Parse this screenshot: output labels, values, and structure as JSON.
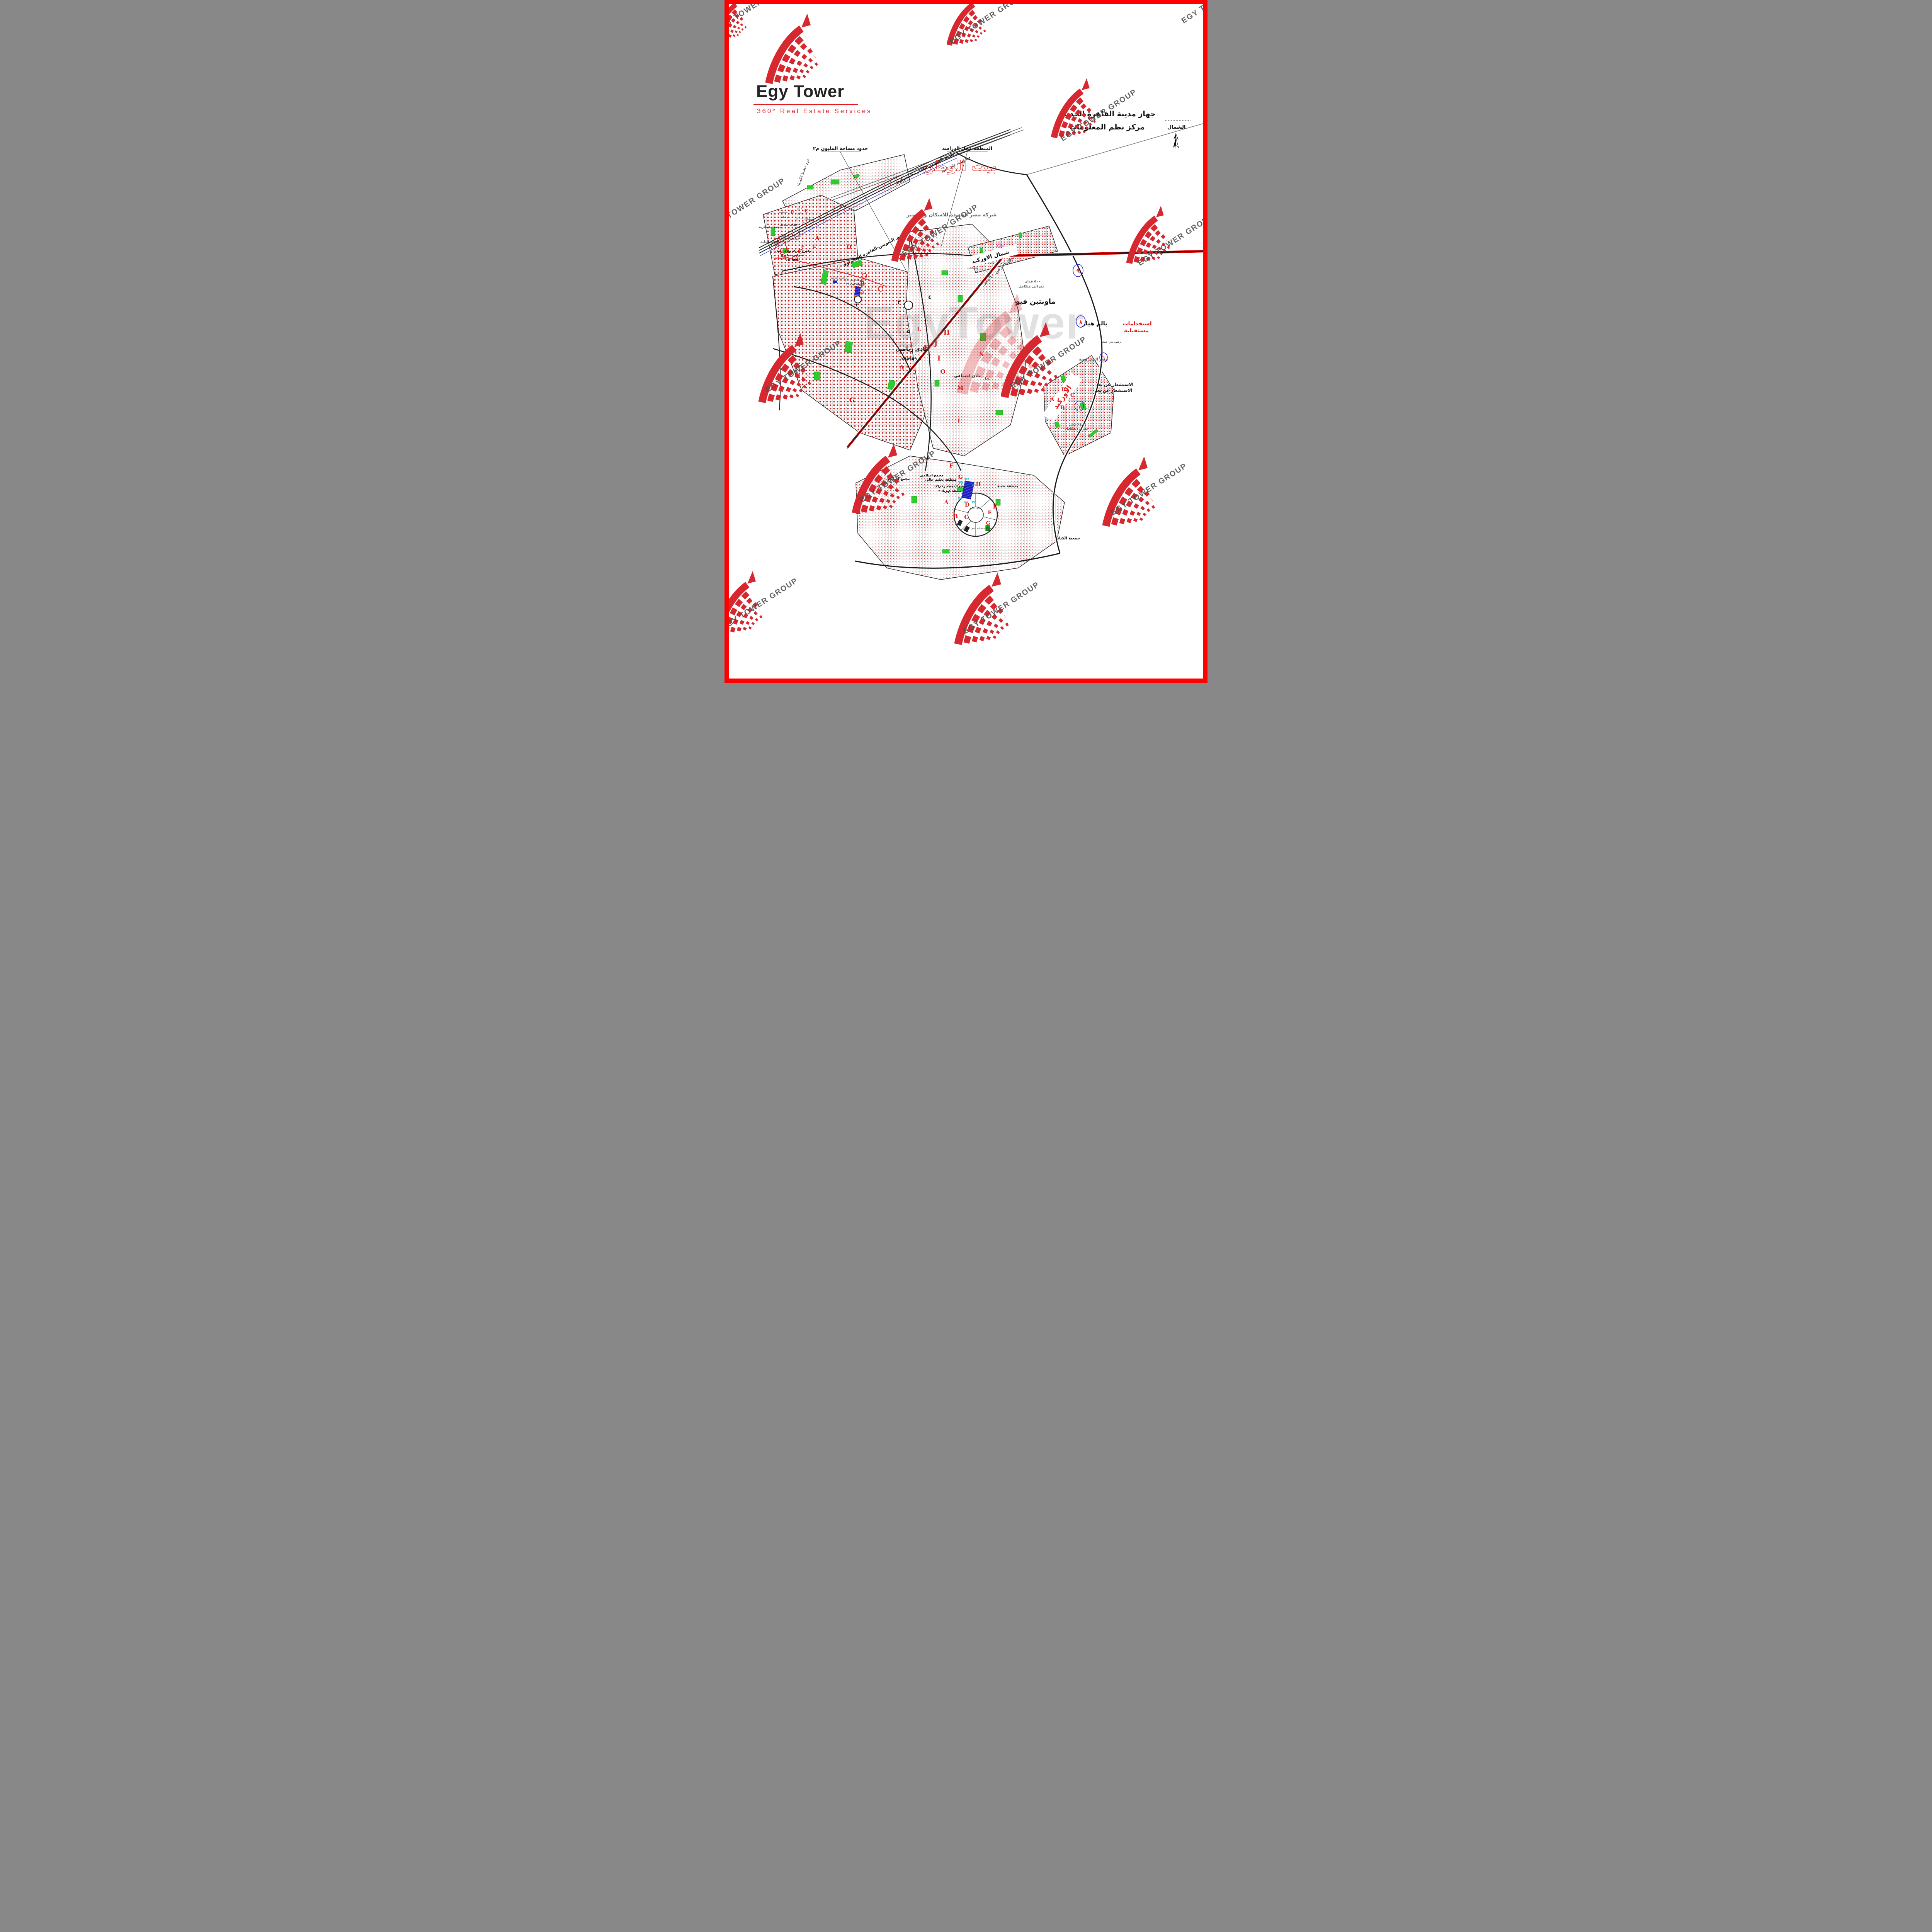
{
  "page": {
    "border_color": "#fe0000",
    "background": "#ffffff"
  },
  "logo": {
    "title": "Egy Tower",
    "tagline": "360° Real Estate Services"
  },
  "header": {
    "authority_line1": "جهاز مدينة القاهرة الجديدة",
    "authority_line2": "مركز نظم المعلومات"
  },
  "compass": {
    "label": "الشمال"
  },
  "watermark": {
    "text": "EGY TOWER GROUP",
    "big_text": "EgyTower"
  },
  "map": {
    "title": "بيت الوطن",
    "developer": "شركة مصر الجديدة للاسكان والتعمير",
    "callouts": {
      "million_area": "حدود مساحة المليون م٢",
      "study_area": "المنطقة محل الدراسة"
    },
    "roads": {
      "suez_desert": "طريق السويس-القاهرة الصحراوى",
      "width60": "طريق بعرض ٦٠متر",
      "hv_line": "خط كهرباء عالى الجهد",
      "hv_row": "حرم خطوط الكهرباء"
    },
    "zones": {
      "military": "منطقة عسكرية",
      "intelligence": "المخابرات العامة",
      "karnak_proposal": "مقترح شركة الكرنك",
      "karnak_area": "42123.369 m2",
      "wadi_nile_proposal": "مقترح شركة وادى النيل",
      "urban_integrated": "عمرانى متكامل",
      "ten_fed": "10 fed",
      "services": "خدمات",
      "services_red": "خدمات",
      "mosque": "مسجد",
      "grand_mosque": "مسجد جامع",
      "admin": "ادارى",
      "commercial": "تجارى",
      "social_club": "نادى اجتماعى",
      "sports_club": "نادى رياضى",
      "sports_club_area": "٢٩٥٩٥٩٫٨",
      "islamic_complex": "مجمع اسلامى",
      "higher_education": "منطقة تعليم عالى",
      "medical": "منطقة طبية",
      "station2_line1": "موقع المحطة رقم(٢)",
      "station2_line2": "محطة كهرباء ٢",
      "station1_line1": "المحطة رقم( ١ )",
      "station1_line2": "محطة كهرباء ١",
      "service_lands": "اراضى خدمية",
      "services_center8": "مركز خدمات الحى الثامن",
      "future": "مستقبلى",
      "future_uses_line1": "استخدامات",
      "future_uses_line2": "مستقبلية",
      "remote_sensing": "الاستشعار عن بعد",
      "misr_mahrousa": "مصر المحروسة",
      "kenana": "جمعية الكنانة",
      "mountain_view": "ماونتين فيو",
      "palm_hills": "بالم هيلز",
      "orchid": "الاوركيد",
      "north_orchid": "شمال الاوركيد",
      "fed500_line1": "٥٠٠ فدان",
      "fed500_line2": "عمرانى متكامل",
      "fed8784_line1": "٨٧٫٨٤ فدان",
      "fed8784_line2": "عمرانى متكامل",
      "leisure": "ترفيهى-تجارى-فندقى"
    },
    "circled_numbers": {
      "n9": "٩",
      "n8": "٨",
      "n6": "٦",
      "n1": "١"
    },
    "road_numbers": {
      "n3": "٣",
      "n3b": "٣",
      "n4": "٤",
      "n5": "٥"
    },
    "points": {
      "P1": "P1",
      "P2": "P2",
      "P3": "P3",
      "P4": "P4",
      "P5": "P5",
      "P6": "P6",
      "p1": "p1",
      "p2": "p2",
      "p3": "p3",
      "p4": "p4"
    },
    "district_letters": [
      "A",
      "C",
      "D",
      "E",
      "C",
      "A",
      "F",
      "E",
      "B",
      "H",
      "J",
      "K",
      "I",
      "O",
      "L",
      "A",
      "G",
      "M",
      "N",
      "G",
      "L",
      "F",
      "G",
      "H",
      "D",
      "E",
      "C",
      "B",
      "A",
      "F",
      "G",
      "H",
      "D",
      "C",
      "B",
      "A"
    ]
  }
}
